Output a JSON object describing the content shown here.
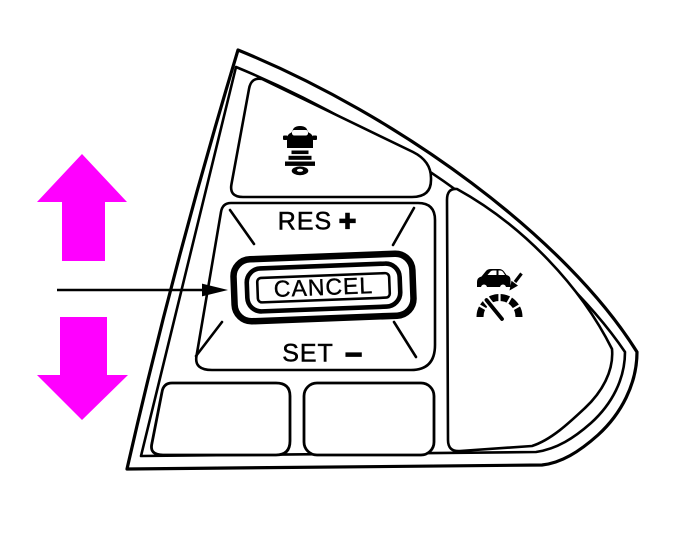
{
  "colors": {
    "background": "#ffffff",
    "line": "#000000",
    "highlight_arrow": "#ff00ff"
  },
  "panel": {
    "buttons": {
      "distance": {
        "icon": "following-distance-icon"
      },
      "res_plus": {
        "label": "RES",
        "symbol": "+"
      },
      "cancel": {
        "label": "CANCEL"
      },
      "set_minus": {
        "label": "SET",
        "symbol": "−"
      },
      "acc": {
        "icon": "adaptive-cruise-control-icon"
      },
      "lower_left": {
        "label": ""
      },
      "lower_right": {
        "label": ""
      }
    }
  },
  "annotations": {
    "up_arrow": {
      "icon": "up-arrow",
      "color": "#ff00ff"
    },
    "down_arrow": {
      "icon": "down-arrow",
      "color": "#ff00ff"
    },
    "pointer": {
      "icon": "leader-arrow",
      "points_to": "CANCEL"
    }
  }
}
